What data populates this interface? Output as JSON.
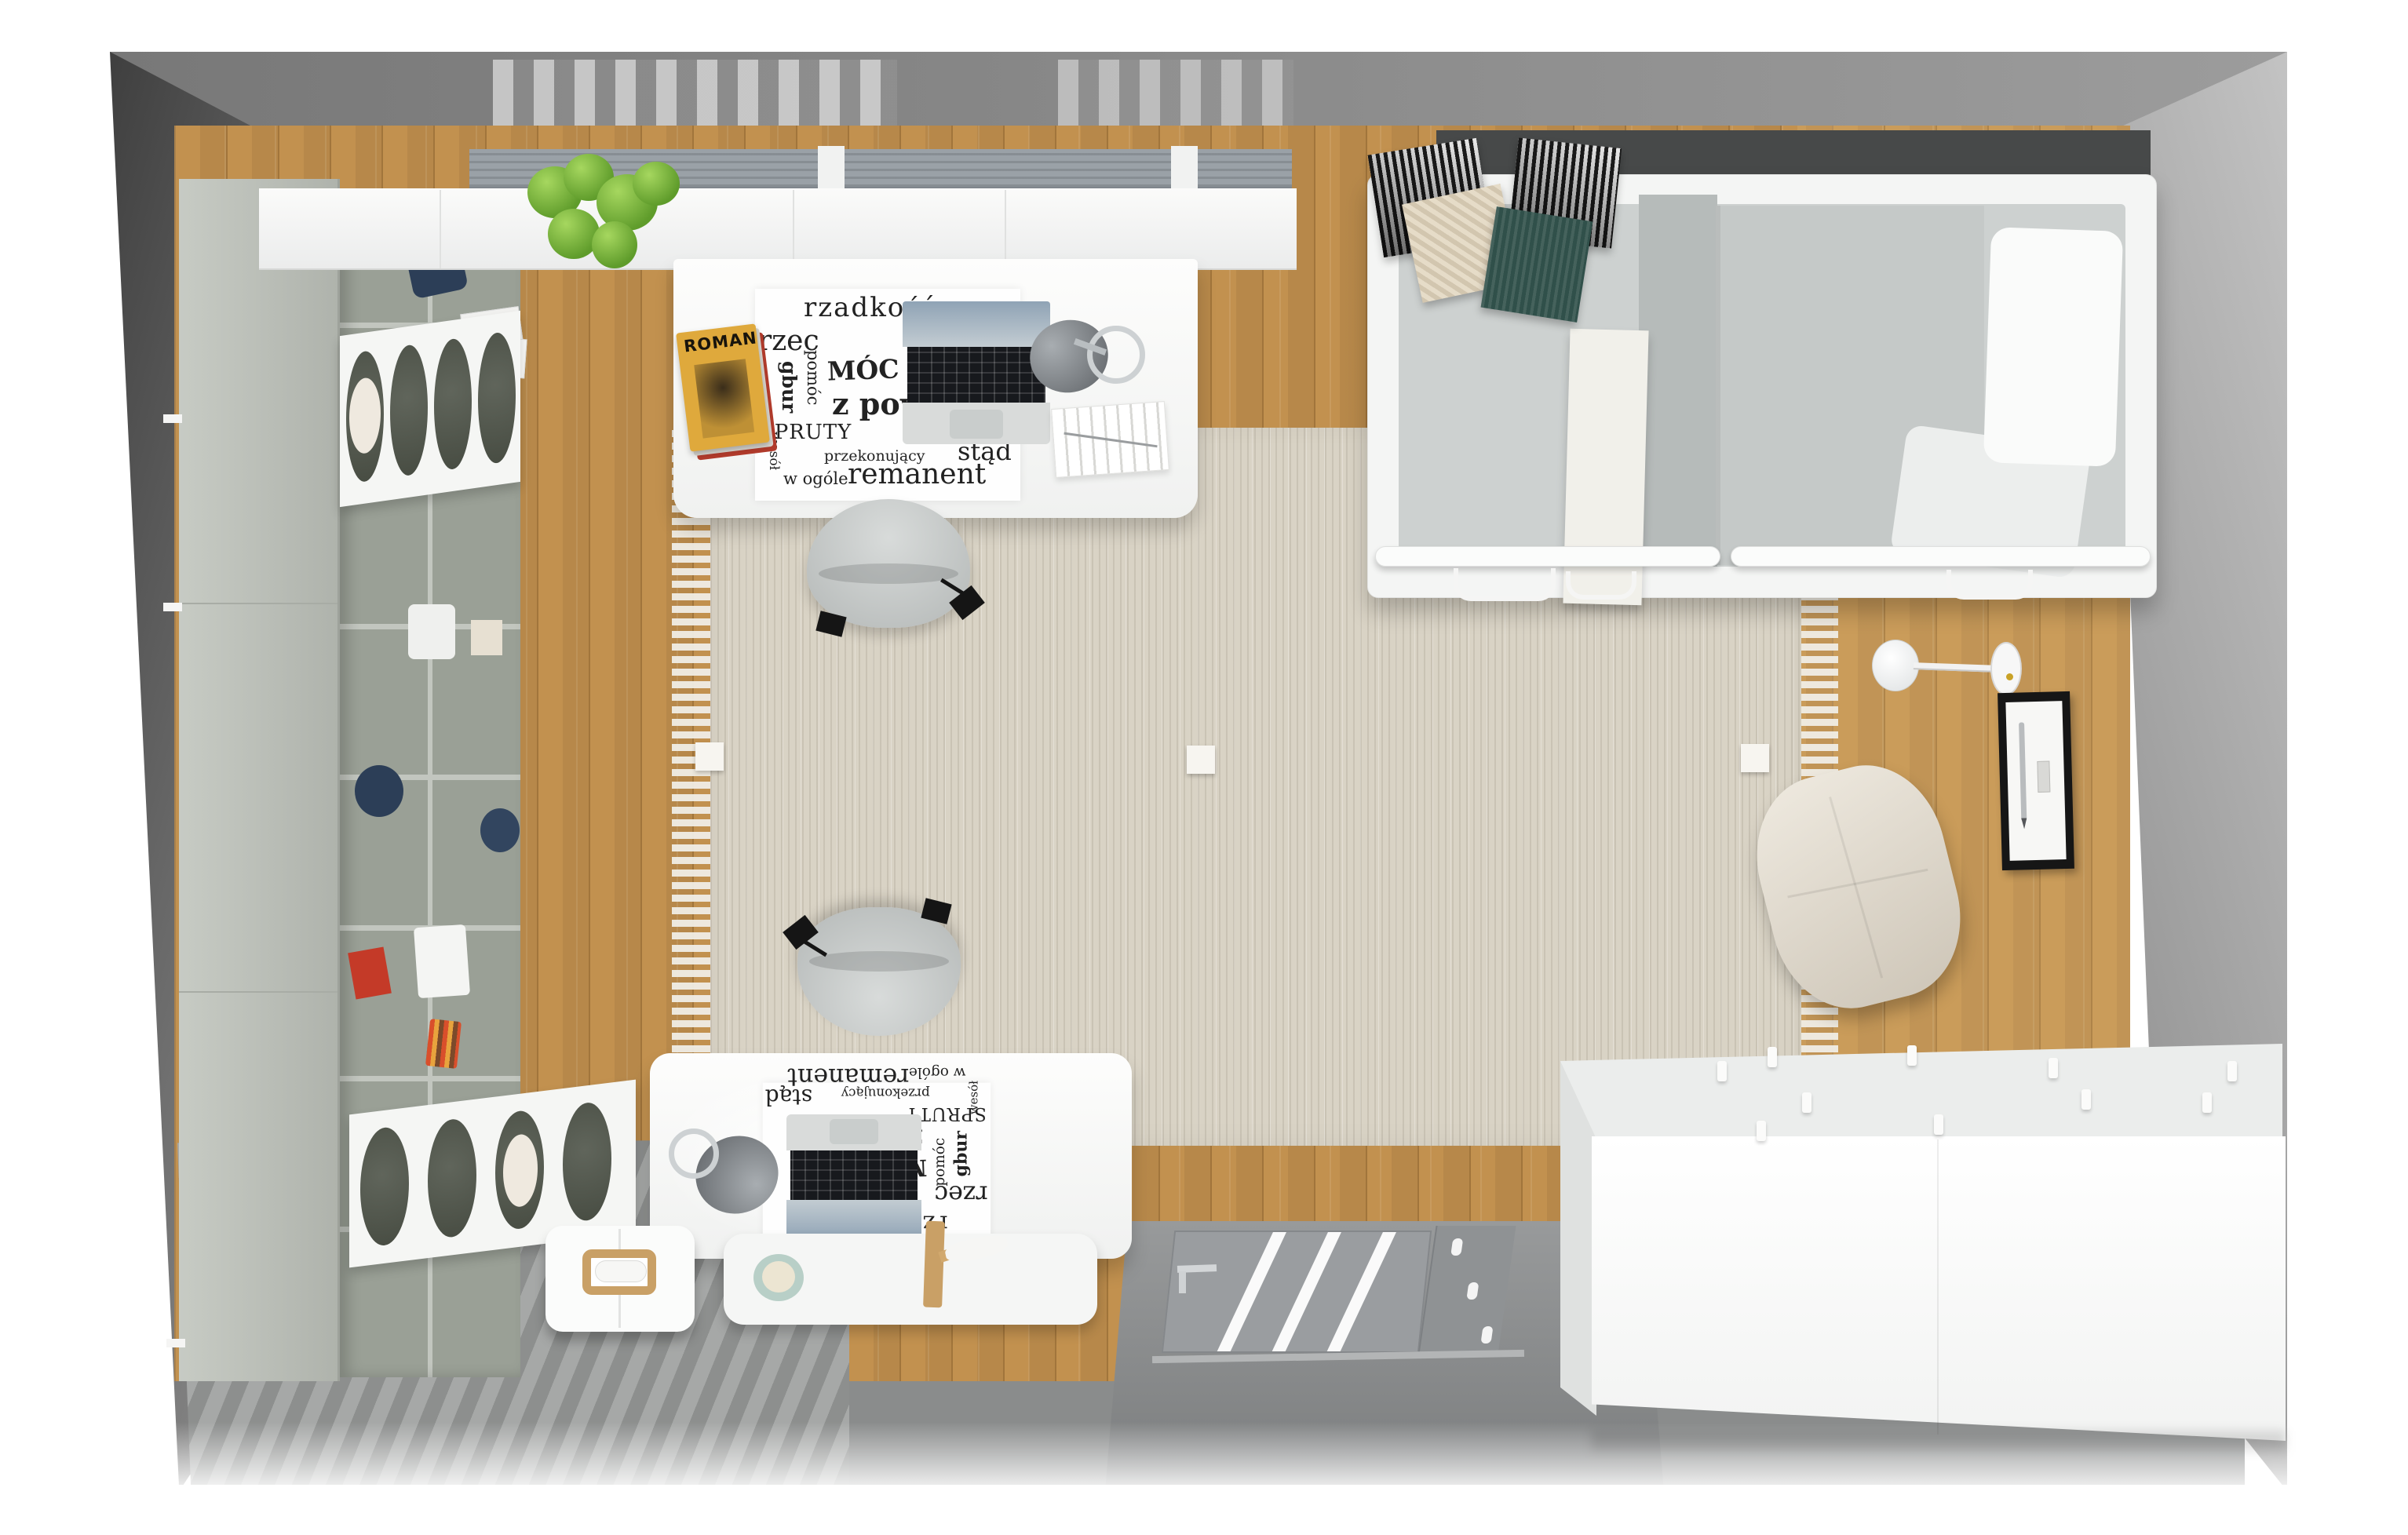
{
  "scene": {
    "description": "Top-down 3D render of a teen bedroom-study with wood floor, beige rug and white furniture",
    "objects": [
      "wardrobe-shelf-unit",
      "window-blinds",
      "potted-plant",
      "desk",
      "office-chair",
      "typography-desk-mat",
      "laptop",
      "magazine-stack",
      "desk-lamp",
      "area-rug",
      "single-bed",
      "knit-pillows",
      "wall-lamp",
      "picture-frame",
      "pouf",
      "storage-cabinet",
      "entrance-door",
      "striped-carpet",
      "desk-organizer",
      "hotspot-markers"
    ]
  },
  "desk_mat": {
    "w1": "rzadkość",
    "w2": "rzec",
    "w3": "MÓC",
    "w4": "wła",
    "w5": "z powr",
    "w6": "SPRUTY",
    "w7": "przekonujący",
    "w8": "stąd",
    "w9": "w ogóle",
    "w10": "remanent",
    "v1": "pomóc",
    "v2": "gbur",
    "v3": "wesół"
  },
  "magazine": {
    "title": "ROMAN"
  },
  "hotspots": {
    "count": 3
  },
  "colors": {
    "wood": "#c2914f",
    "rug": "#d9d3c5",
    "wall": "#8d8d8d",
    "carpet": "#9a9c9b",
    "plant": "#5f9c2b",
    "navy": "#2c3e57",
    "pouf": "#cdc5b7",
    "greenPillow": "#30504a",
    "beigePillow": "#e6dcc8",
    "magazine": "#dfa93c",
    "door": "#9a9da0",
    "mint": "#b8cfc7",
    "oak": "#c9a066"
  }
}
